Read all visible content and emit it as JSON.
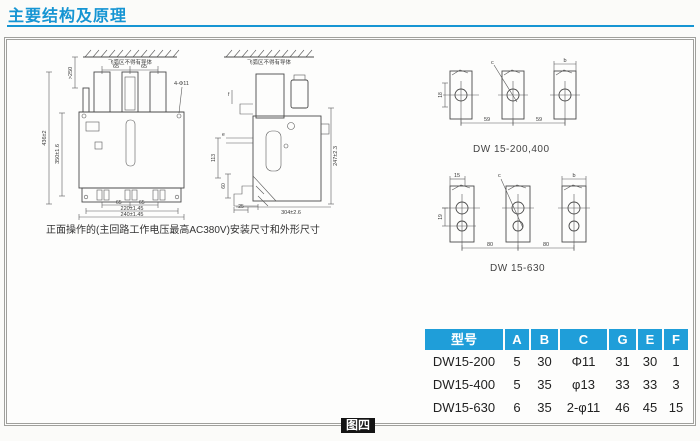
{
  "page": {
    "title": "主要结构及原理",
    "figure_label": "图四",
    "accent_color": "#1695d3",
    "table_header_color": "#1f9ed9"
  },
  "front_view": {
    "arc_note": "飞弧区不得有导体",
    "caption": "正面操作的(主回路工作电压最高AC380V)安装尺寸和外形尺寸",
    "dims": {
      "clearance": ">250",
      "top_span_1": "65",
      "top_span_2": "65",
      "holes": "4-Φ11",
      "height": "436±2",
      "inner_height": "350±1.6",
      "bottom_span_1": "65",
      "bottom_span_2": "65",
      "inner_width": "220±1.45",
      "outer_width": "240±1.45"
    }
  },
  "side_view": {
    "arc_note": "飞弧区不得有导体",
    "dims": {
      "f": "f",
      "e": "e",
      "v113": "113",
      "v60": "60",
      "d25": "25",
      "height": "247±2.3",
      "depth": "304±2.6"
    }
  },
  "busbar_200_400": {
    "caption": "DW 15-200,400",
    "dims": {
      "c": "c",
      "b": "b",
      "edge": "18",
      "pitch_1": "59",
      "pitch_2": "59"
    }
  },
  "busbar_630": {
    "caption": "DW 15-630",
    "dims": {
      "top": "15",
      "c": "c",
      "b": "b",
      "edge": "19",
      "pitch_1": "80",
      "pitch_2": "80"
    }
  },
  "spec_table": {
    "headers": [
      "型号",
      "A",
      "B",
      "C",
      "G",
      "E",
      "F"
    ],
    "rows": [
      [
        "DW15-200",
        "5",
        "30",
        "Φ11",
        "31",
        "30",
        "1"
      ],
      [
        "DW15-400",
        "5",
        "35",
        "φ13",
        "33",
        "33",
        "3"
      ],
      [
        "DW15-630",
        "6",
        "35",
        "2-φ11",
        "46",
        "45",
        "15"
      ]
    ]
  }
}
